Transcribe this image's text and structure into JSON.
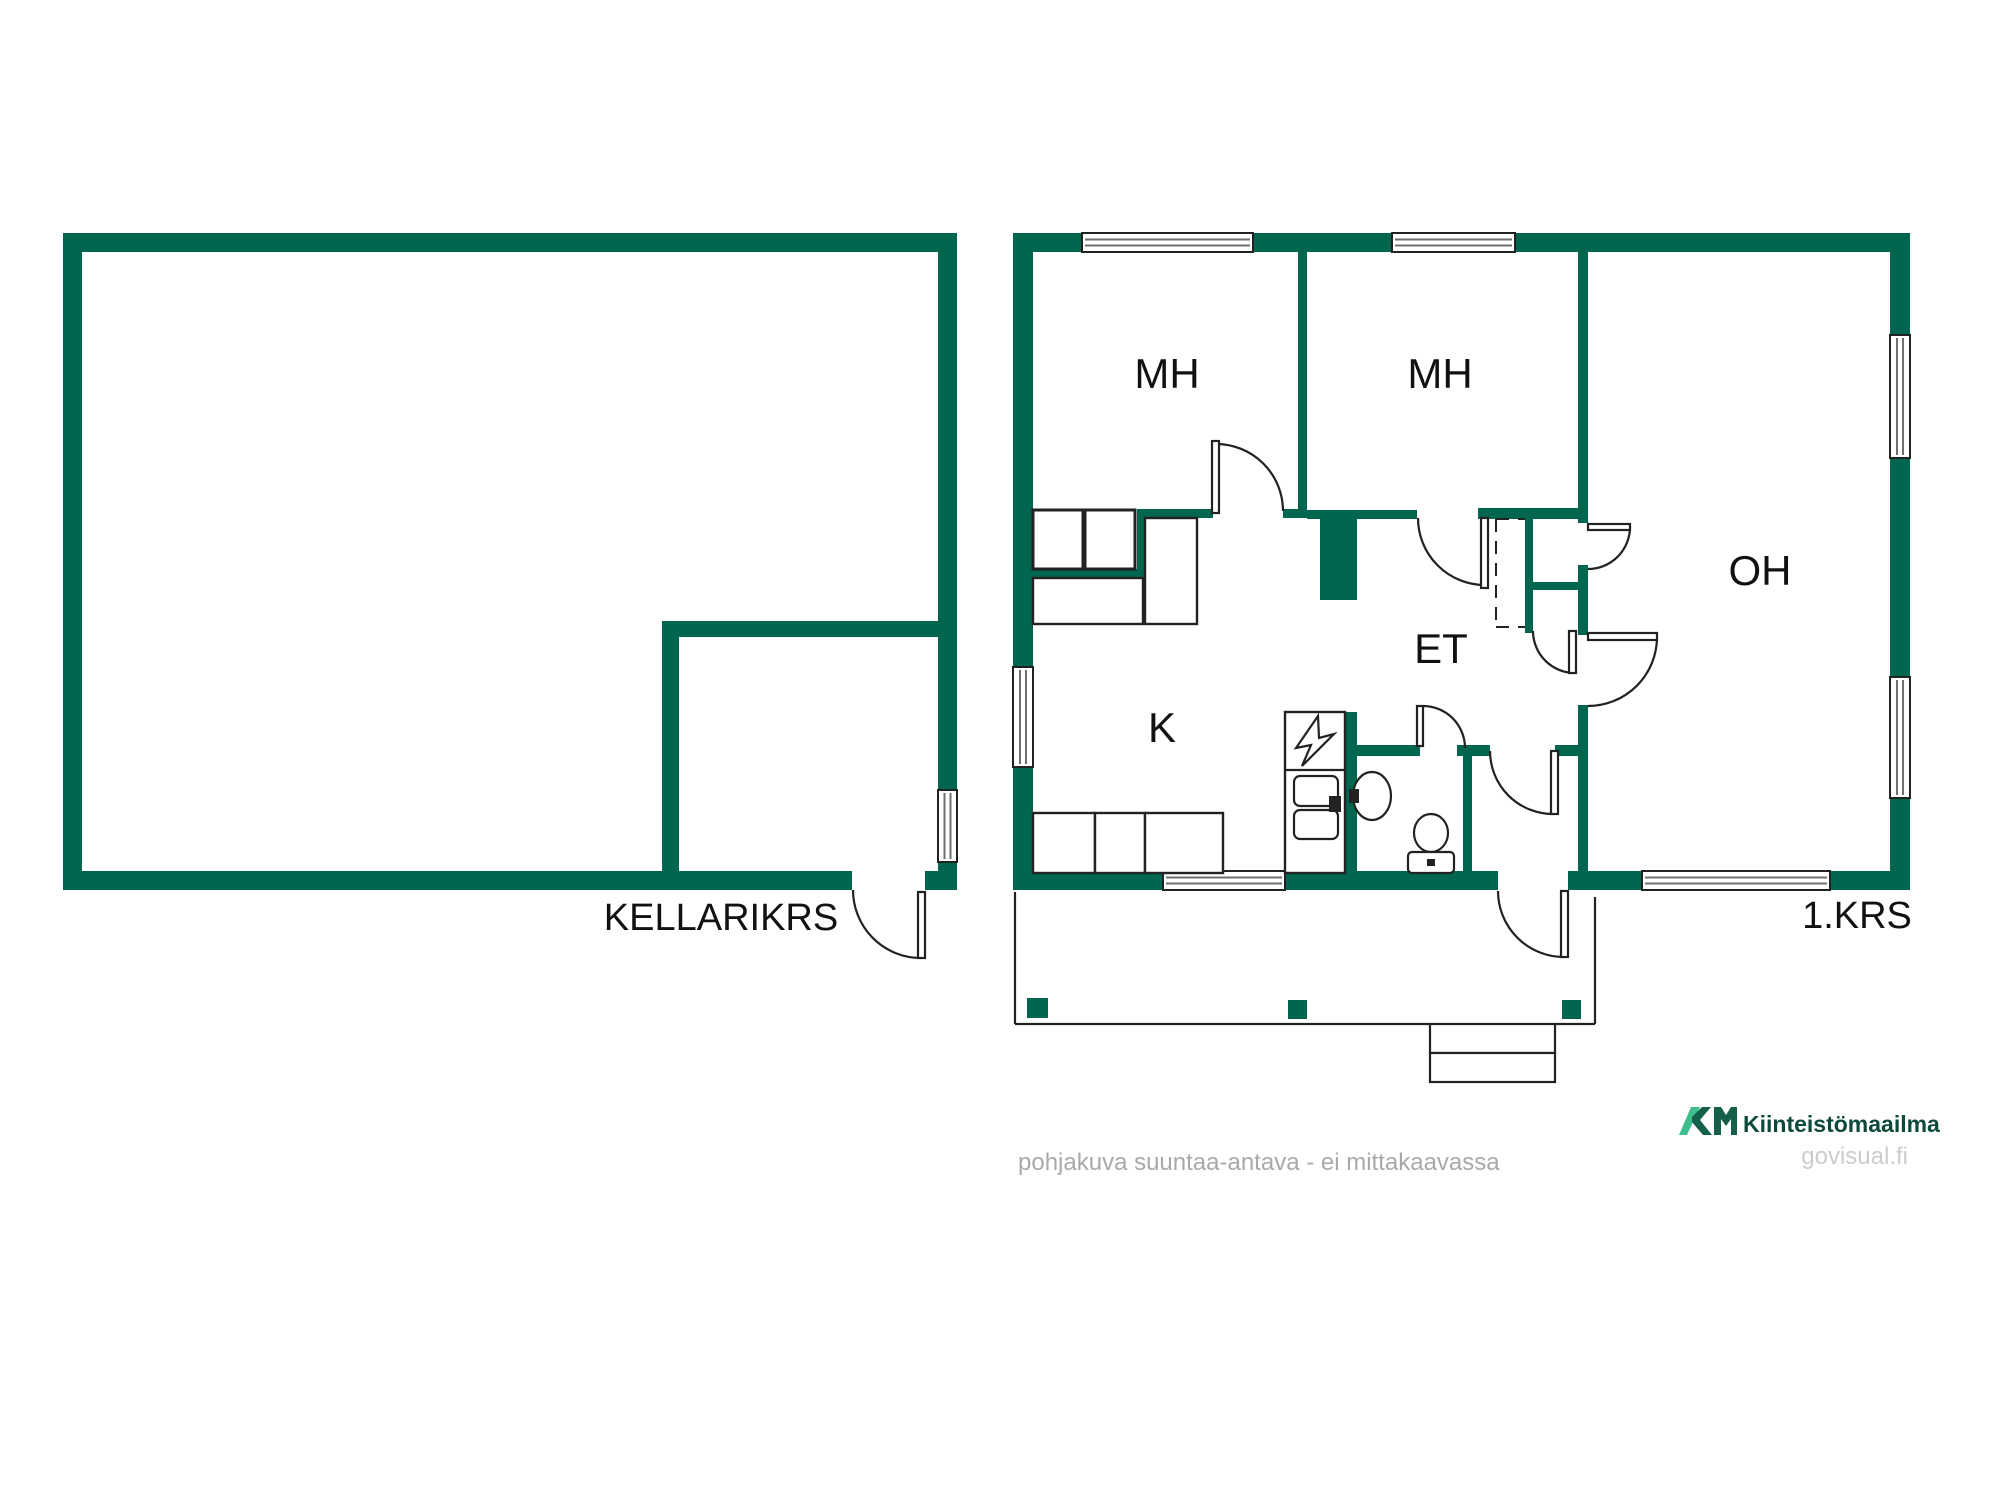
{
  "labels": {
    "bedroom1": "MH",
    "bedroom2": "MH",
    "living_room": "OH",
    "hallway": "ET",
    "kitchen": "K",
    "basement_floor": "KELLARIKRS",
    "first_floor": "1.KRS"
  },
  "footer": {
    "disclaimer": "pohjakuva suuntaa-antava - ei mittakaavassa",
    "brand": "Kiinteistömaailma",
    "site": "govisual.fi"
  },
  "colors": {
    "wall": "#00664F",
    "line": "#222222",
    "window_line": "#6f6f6f",
    "logo_light": "#3FBE8D",
    "logo_dark": "#15604B",
    "brand_text": "#0D4A3C",
    "site_text": "#C9CDCC",
    "muted_text": "#A9A9A9",
    "label_text": "#111111"
  },
  "plan": {
    "walls": [
      [
        63,
        233,
        894,
        19
      ],
      [
        63,
        252,
        19,
        638
      ],
      [
        938,
        252,
        19,
        538
      ],
      [
        938,
        862,
        19,
        9
      ],
      [
        63,
        871,
        789,
        19
      ],
      [
        925,
        871,
        32,
        19
      ],
      [
        662,
        621,
        278,
        16
      ],
      [
        662,
        621,
        17,
        250
      ],
      [
        1013,
        233,
        897,
        19
      ],
      [
        1013,
        252,
        20,
        619
      ],
      [
        1890,
        252,
        20,
        619
      ],
      [
        1013,
        871,
        485,
        19
      ],
      [
        1568,
        871,
        342,
        19
      ],
      [
        1298,
        252,
        9,
        266
      ],
      [
        1137,
        509,
        76,
        9
      ],
      [
        1283,
        509,
        24,
        9
      ],
      [
        1137,
        509,
        9,
        69
      ],
      [
        1033,
        569,
        110,
        9
      ],
      [
        1307,
        510,
        110,
        9
      ],
      [
        1478,
        508,
        110,
        11
      ],
      [
        1320,
        518,
        37,
        82
      ],
      [
        1345,
        712,
        12,
        159
      ],
      [
        1357,
        745,
        63,
        11
      ],
      [
        1457,
        745,
        33,
        11
      ],
      [
        1555,
        745,
        33,
        11
      ],
      [
        1463,
        756,
        9,
        115
      ],
      [
        1578,
        252,
        10,
        271
      ],
      [
        1578,
        565,
        10,
        70
      ],
      [
        1578,
        705,
        10,
        166
      ],
      [
        1525,
        518,
        8,
        115
      ],
      [
        1532,
        582,
        48,
        8
      ]
    ],
    "windows": [
      [
        1082,
        233,
        171,
        19,
        "h"
      ],
      [
        1392,
        233,
        123,
        19,
        "h"
      ],
      [
        1890,
        335,
        20,
        123,
        "v"
      ],
      [
        1890,
        677,
        20,
        121,
        "v"
      ],
      [
        1642,
        871,
        188,
        19,
        "h"
      ],
      [
        1163,
        871,
        122,
        19,
        "h"
      ],
      [
        1013,
        667,
        20,
        100,
        "v"
      ],
      [
        938,
        790,
        19,
        72,
        "v"
      ]
    ],
    "doors": [
      {
        "leaf": [
          1212,
          441,
          7,
          72
        ],
        "hinge": [
          1216,
          511
        ],
        "start": [
          1216,
          444
        ],
        "end": [
          1283,
          511
        ]
      },
      {
        "leaf": [
          1481,
          518,
          7,
          70
        ],
        "hinge": [
          1485,
          518
        ],
        "start": [
          1418,
          518
        ],
        "end": [
          1485,
          585
        ]
      },
      {
        "leaf": [
          1588,
          524,
          42,
          6
        ],
        "hinge": [
          1588,
          527
        ],
        "start": [
          1630,
          527
        ],
        "end": [
          1588,
          569
        ]
      },
      {
        "leaf": [
          1588,
          633,
          69,
          7
        ],
        "hinge": [
          1588,
          637
        ],
        "start": [
          1657,
          637
        ],
        "end": [
          1588,
          706
        ]
      },
      {
        "leaf": [
          1569,
          631,
          7,
          42
        ],
        "hinge": [
          1575,
          631
        ],
        "start": [
          1533,
          631
        ],
        "end": [
          1575,
          673
        ]
      },
      {
        "leaf": [
          1417,
          706,
          6,
          40
        ],
        "hinge": [
          1423,
          748
        ],
        "start": [
          1423,
          706
        ],
        "end": [
          1465,
          748
        ]
      },
      {
        "leaf": [
          1551,
          751,
          7,
          63
        ],
        "hinge": [
          1553,
          751
        ],
        "start": [
          1490,
          751
        ],
        "end": [
          1553,
          814
        ]
      },
      {
        "leaf": [
          1561,
          891,
          7,
          66
        ],
        "hinge": [
          1564,
          891
        ],
        "start": [
          1498,
          891
        ],
        "end": [
          1564,
          957
        ]
      },
      {
        "leaf": [
          918,
          892,
          7,
          66
        ],
        "hinge": [
          921,
          890
        ],
        "start": [
          853,
          890
        ],
        "end": [
          921,
          958
        ]
      }
    ],
    "dashed_lines": [
      [
        1496,
        519,
        1496,
        627
      ],
      [
        1496,
        627,
        1525,
        627
      ],
      [
        1496,
        519,
        1525,
        519
      ]
    ],
    "furniture": [
      [
        1033,
        510,
        50,
        59,
        3
      ],
      [
        1085,
        510,
        50,
        59,
        3
      ],
      [
        1033,
        578,
        110,
        46,
        2.4
      ],
      [
        1145,
        518,
        52,
        106,
        2.4
      ],
      [
        1033,
        813,
        62,
        60,
        2.4
      ],
      [
        1095,
        813,
        50,
        60,
        2.4
      ],
      [
        1145,
        813,
        78,
        60,
        2.4
      ],
      [
        1285,
        712,
        60,
        161,
        2.4
      ]
    ],
    "fixtures": [
      {
        "t": "line",
        "n": "counter-divider",
        "p": [
          1285,
          770,
          1345,
          770
        ]
      },
      {
        "t": "path",
        "n": "electrical-panel-symbol",
        "d": "M1318,716 L1296,748 L1311,745 L1302,766 L1334,734 L1319,738 Z"
      },
      {
        "t": "rrect",
        "n": "sink-bowl",
        "p": [
          1294,
          776,
          44,
          30,
          6
        ]
      },
      {
        "t": "rrect",
        "n": "sink-bowl",
        "p": [
          1294,
          810,
          44,
          29,
          6
        ]
      },
      {
        "t": "fill",
        "n": "faucet",
        "p": [
          1329,
          796,
          12,
          16
        ]
      },
      {
        "t": "ellipse",
        "n": "washbasin",
        "p": [
          1372,
          796,
          19,
          24
        ]
      },
      {
        "t": "fill",
        "n": "washbasin-tap",
        "p": [
          1349,
          789,
          10,
          14
        ]
      },
      {
        "t": "ellipse",
        "n": "toilet-bowl",
        "p": [
          1431,
          833,
          17,
          19
        ]
      },
      {
        "t": "rrect",
        "n": "toilet-tank",
        "p": [
          1408,
          852,
          46,
          21,
          4
        ]
      },
      {
        "t": "fill",
        "n": "flush-button",
        "p": [
          1427,
          859,
          8,
          7
        ]
      }
    ],
    "terrace": {
      "lines": [
        [
          1015,
          892,
          1015,
          1024
        ],
        [
          1015,
          1024,
          1430,
          1024
        ],
        [
          1555,
          1024,
          1595,
          1024
        ],
        [
          1595,
          897,
          1595,
          1024
        ]
      ],
      "steps": [
        [
          1430,
          1024,
          125,
          29
        ],
        [
          1430,
          1053,
          125,
          29
        ]
      ],
      "posts": [
        [
          1027,
          998,
          21,
          20
        ],
        [
          1288,
          1000,
          19,
          19
        ],
        [
          1562,
          1000,
          19,
          19
        ]
      ]
    }
  }
}
